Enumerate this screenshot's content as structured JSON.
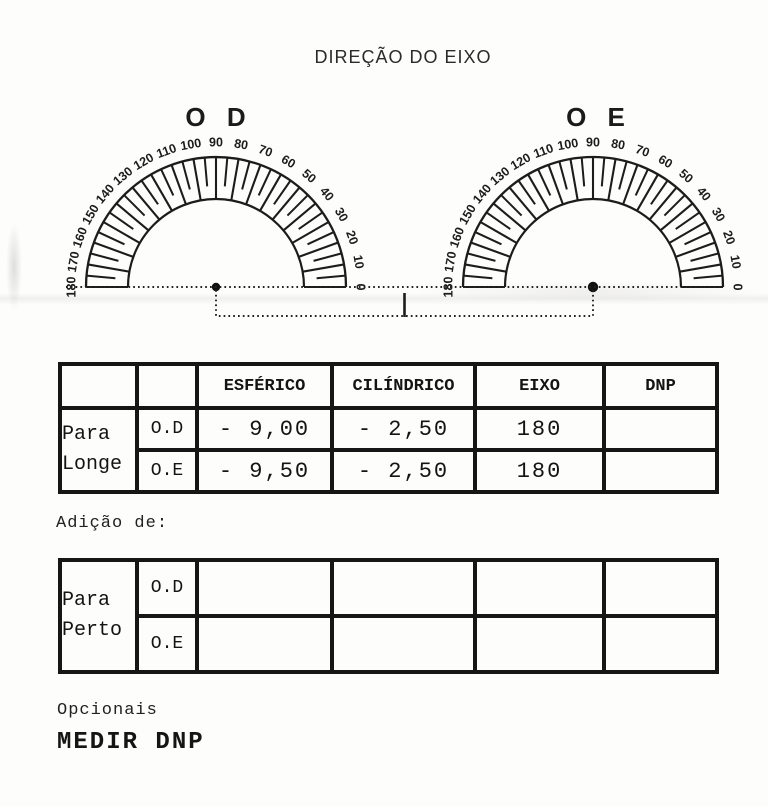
{
  "title": "DIREÇÃO DO EIXO",
  "protractors": {
    "od_label": "O D",
    "oe_label": "O E",
    "tick_labels": [
      180,
      170,
      160,
      150,
      140,
      130,
      120,
      110,
      100,
      90,
      80,
      70,
      60,
      50,
      40,
      30,
      20,
      10,
      0
    ]
  },
  "prescription_table": {
    "headers": {
      "esferico": "ESFÉRICO",
      "cilindrico": "CILÍNDRICO",
      "eixo": "EIXO",
      "dnp": "DNP"
    },
    "group_label_line1": "Para",
    "group_label_line2": "Longe",
    "rows": [
      {
        "eye": "O.D",
        "esferico": "- 9,00",
        "cilindrico": "- 2,50",
        "eixo": "180",
        "dnp": ""
      },
      {
        "eye": "O.E",
        "esferico": "- 9,50",
        "cilindrico": "- 2,50",
        "eixo": "180",
        "dnp": ""
      }
    ]
  },
  "adicao_label": "Adição de:",
  "near_table": {
    "group_label_line1": "Para",
    "group_label_line2": "Perto",
    "rows": [
      {
        "eye": "O.D",
        "esferico": "",
        "cilindrico": "",
        "eixo": "",
        "dnp": ""
      },
      {
        "eye": "O.E",
        "esferico": "",
        "cilindrico": "",
        "eixo": "",
        "dnp": ""
      }
    ]
  },
  "footer": {
    "opcionais": "Opcionais",
    "medir_dnp": "MEDIR DNP"
  },
  "colors": {
    "ink": "#1c1c1c",
    "paper": "#fdfdfc"
  }
}
